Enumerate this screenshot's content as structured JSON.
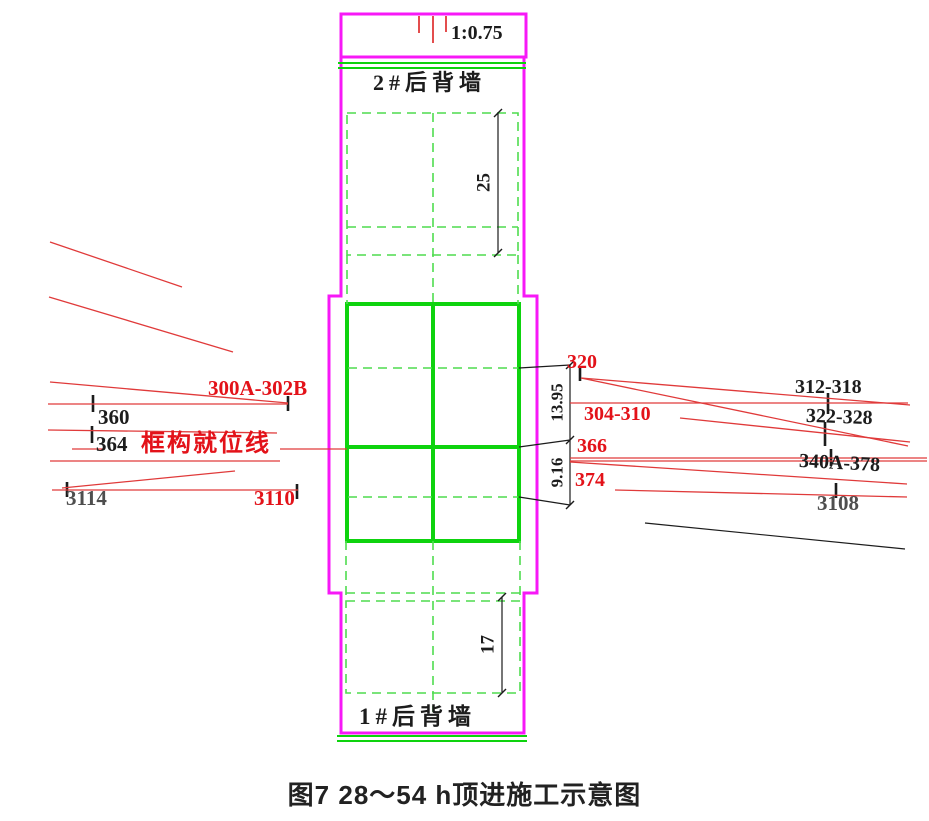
{
  "scale_box": {
    "ratio": "1:0.75"
  },
  "walls": {
    "top": "2#后背墙",
    "bottom": "1#后背墙"
  },
  "dimensions": {
    "top": "25",
    "upper_right": "13.95",
    "lower_right": "9.16",
    "bottom": "17"
  },
  "left_labels": {
    "group_a": "300A-302B",
    "l360": "360",
    "l364": "364",
    "positioning_line": "框构就位线",
    "l3114": "3114",
    "l3110": "3110"
  },
  "right_labels": {
    "l320": "320",
    "l312_318": "312-318",
    "l304_310": "304-310",
    "l322_328": "322-328",
    "l366": "366",
    "l340a_378": "340A-378",
    "l374": "374",
    "l3108": "3108"
  },
  "caption": "图7 28～54 h顶进施工示意图",
  "colors": {
    "magenta": "#f718f7",
    "green": "#0ed30e",
    "green_dash": "#4fdc4f",
    "red": "#e03a3a",
    "red_text": "#e31219",
    "black": "#1c1c1c",
    "gray": "#4e4e4e"
  }
}
